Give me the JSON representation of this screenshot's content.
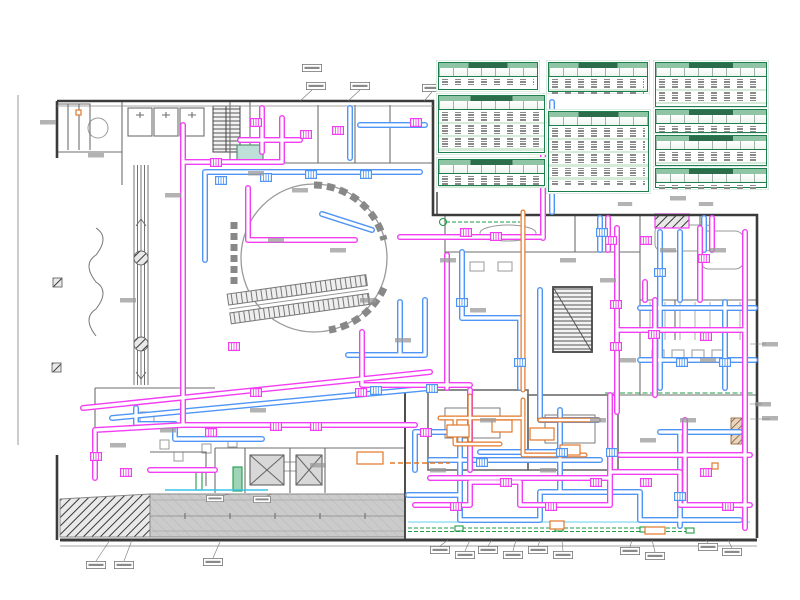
{
  "document": {
    "type": "mechanical-hvac-floor-plan-drawing",
    "background": "#ffffff",
    "text_rendering": "microprint-illegible-at-source-resolution"
  },
  "palette": {
    "duct_magenta": "#f23df2",
    "duct_blue": "#4e95f5",
    "duct_orange": "#e2782a",
    "line_cyan": "#3cc3e8",
    "line_green": "#1f9d46",
    "wall_dark": "#3b3b3b",
    "partition_gray": "#777777",
    "detail_gray": "#9a9a9a",
    "ramp_fill": "#cbcbcb",
    "table_border_green": "#1d7f4d",
    "table_title_green": "#8fc4a4",
    "table_band_green": "#d6ead9",
    "hatch_brown": "#8a5a2a"
  },
  "schedules": {
    "count": 9,
    "tables": [
      {
        "id": "schedule-1",
        "x": 438,
        "y": 62,
        "w": 100,
        "h": 28,
        "rows": 3
      },
      {
        "id": "schedule-2",
        "x": 438,
        "y": 95,
        "w": 107,
        "h": 58,
        "rows": 12
      },
      {
        "id": "schedule-3",
        "x": 438,
        "y": 159,
        "w": 107,
        "h": 27,
        "rows": 4
      },
      {
        "id": "schedule-4",
        "x": 548,
        "y": 62,
        "w": 100,
        "h": 30,
        "rows": 5
      },
      {
        "id": "schedule-5",
        "x": 548,
        "y": 111,
        "w": 101,
        "h": 81,
        "rows": 18
      },
      {
        "id": "schedule-6",
        "x": 655,
        "y": 62,
        "w": 112,
        "h": 45,
        "rows": 8
      },
      {
        "id": "schedule-7",
        "x": 655,
        "y": 109,
        "w": 112,
        "h": 24,
        "rows": 3
      },
      {
        "id": "schedule-8",
        "x": 655,
        "y": 135,
        "w": 112,
        "h": 31,
        "rows": 4
      },
      {
        "id": "schedule-9",
        "x": 655,
        "y": 168,
        "w": 112,
        "h": 20,
        "rows": 2
      }
    ],
    "captions_below": 2
  }
}
